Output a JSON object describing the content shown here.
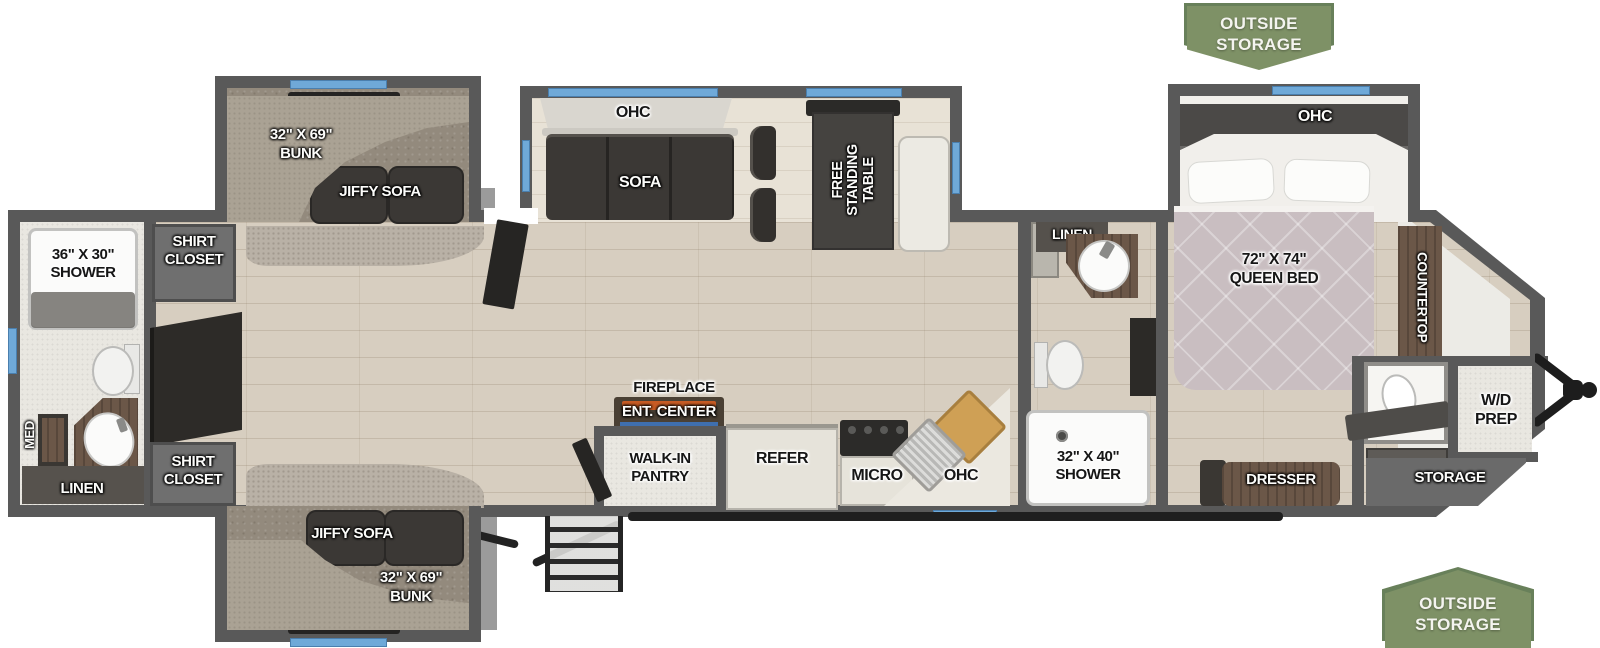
{
  "badges": {
    "top": [
      "OUTSIDE",
      "STORAGE"
    ],
    "bottom": [
      "OUTSIDE",
      "STORAGE"
    ]
  },
  "plan": {
    "bunk_top": {
      "dims": "32\" X 69\"",
      "bunk": "BUNK",
      "sofa": "JIFFY SOFA"
    },
    "bunk_bottom": {
      "dims": "32\" X 69\"",
      "bunk": "BUNK",
      "sofa": "JIFFY SOFA"
    },
    "dinette": {
      "ohc": "OHC",
      "sofa": "SOFA",
      "table": "FREE STANDING TABLE"
    },
    "kitchen": {
      "fireplace": "FIREPLACE",
      "ent_center": "ENT. CENTER",
      "pantry_line1": "WALK-IN",
      "pantry_line2": "PANTRY",
      "refer": "REFER",
      "micro": "MICRO",
      "ohc": "OHC"
    },
    "rear_bath": {
      "shower_dims": "36\" X 30\"",
      "shower": "SHOWER",
      "med": "MED",
      "linen": "LINEN"
    },
    "closets": {
      "shirt_top_1": "SHIRT",
      "shirt_top_2": "CLOSET",
      "shirt_bottom_1": "SHIRT",
      "shirt_bottom_2": "CLOSET"
    },
    "mid_bath": {
      "linen": "LINEN",
      "shower_dims": "32\" X 40\"",
      "shower": "SHOWER"
    },
    "bedroom": {
      "ohc": "OHC",
      "bed_dims": "72\" X 74\"",
      "bed_name": "QUEEN BED",
      "countertop": "COUNTERTOP",
      "dresser": "DRESSER"
    },
    "front": {
      "wd_line1": "W/D",
      "wd_line2": "PREP",
      "storage": "STORAGE"
    }
  },
  "colors": {
    "badge_green": "#7E9166",
    "window_blue": "#6FA9D8",
    "wall_gray": "#595959",
    "floor_wood": "#D7CEC0",
    "carpet_taupe": "#938A7D",
    "bed_mauve": "#C9BEC1",
    "counter_wood": "#6B5748",
    "furniture_dark": "#3B3835",
    "fireplace_orange": "#C75B24",
    "fireplace_blue": "#3F6FAE"
  }
}
